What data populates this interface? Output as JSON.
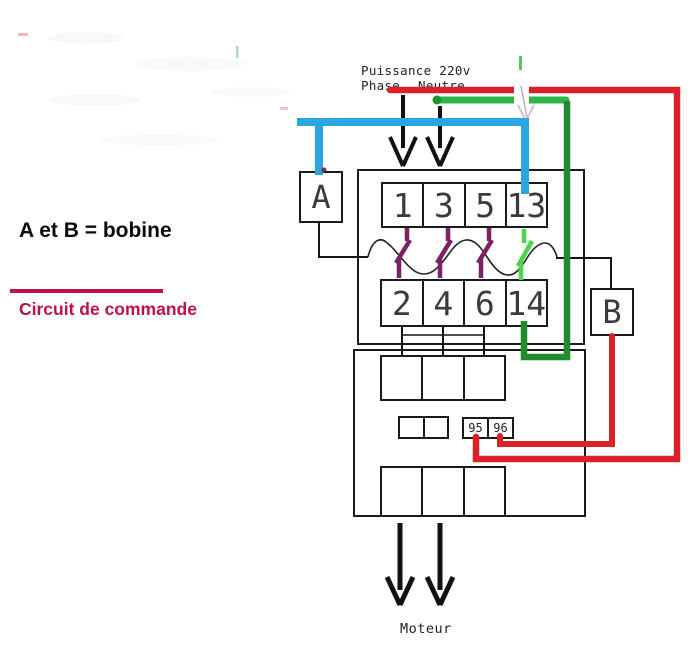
{
  "header": {
    "power": "Puissance 220v",
    "phase": "Phase",
    "neutral": "Neutre"
  },
  "legend": {
    "coil_note": "A et B = bobine",
    "control_circuit": "Circuit de commande"
  },
  "coils": {
    "a": "A",
    "b": "B"
  },
  "contactor": {
    "top_terminals": [
      "1",
      "3",
      "5",
      "13"
    ],
    "bottom_terminals": [
      "2",
      "4",
      "6",
      "14"
    ]
  },
  "relay": {
    "aux_terminals": [
      "95",
      "96"
    ]
  },
  "motor_label": "Moteur",
  "colors": {
    "phase_wire_red": "#da2128",
    "neutral_wire_green": "#2db44a",
    "coil_return_green": "#1f8c2e",
    "control_wire_blue": "#2aa7e1",
    "contact_pole_purple": "#7c2164",
    "contact_no_green": "#4cd44c",
    "annotation_crimson": "#bf1048"
  }
}
